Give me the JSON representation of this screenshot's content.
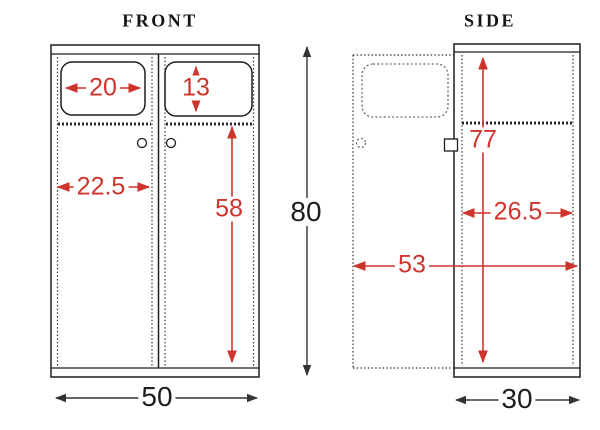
{
  "diagram": {
    "type": "furniture-dimension-drawing",
    "views": {
      "front": {
        "title": "FRONT",
        "dimensions": {
          "window_width": "20",
          "window_height": "13",
          "door_width": "22.5",
          "door_height": "58",
          "overall_height": "80",
          "overall_width": "50"
        }
      },
      "side": {
        "title": "SIDE",
        "dimensions": {
          "body_height": "77",
          "body_depth": "26.5",
          "depth_with_open_door": "53",
          "overall_depth": "30"
        }
      }
    }
  },
  "colors": {
    "line": "#1e1e1e",
    "dimension_red": "#cd342c",
    "background": "#ffffff"
  }
}
